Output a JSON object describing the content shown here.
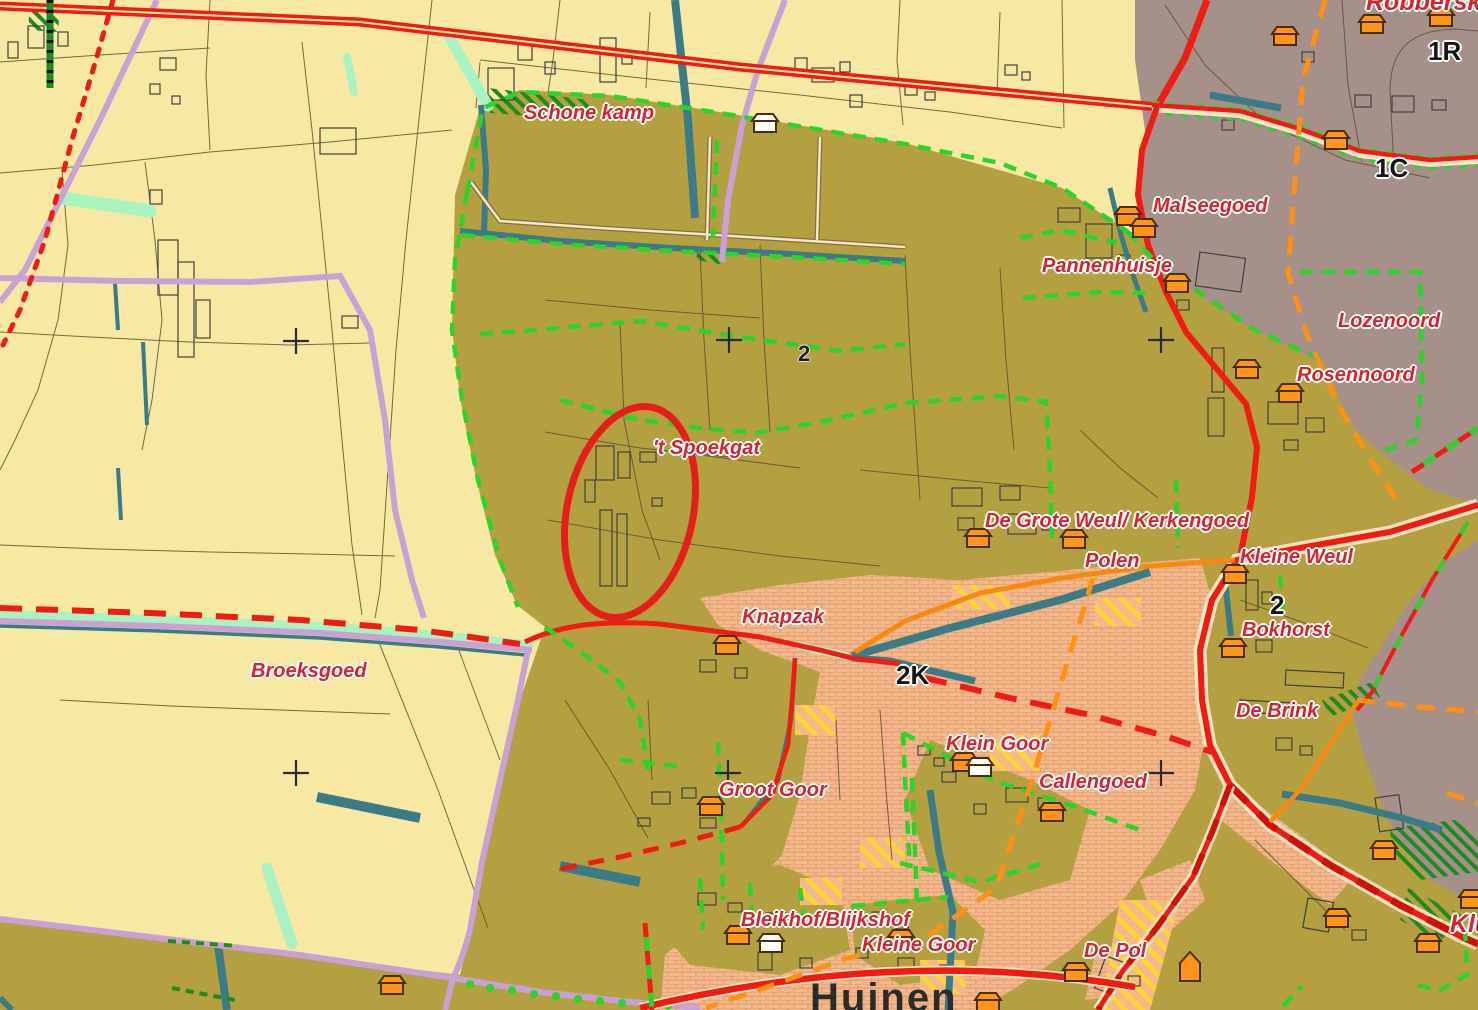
{
  "map": {
    "labels": [
      {
        "id": "schone-kamp",
        "text": "Schone kamp",
        "x": 524,
        "y": 103,
        "kind": "place"
      },
      {
        "id": "robberskamp",
        "text": "Robberskamp",
        "x": 1366,
        "y": -10,
        "kind": "place-lg"
      },
      {
        "id": "malseegoed",
        "text": "Malseegoed",
        "x": 1153,
        "y": 196,
        "kind": "place"
      },
      {
        "id": "pannenhuisje",
        "text": "Pannenhuisje",
        "x": 1042,
        "y": 256,
        "kind": "place"
      },
      {
        "id": "lozenoord",
        "text": "Lozenoord",
        "x": 1338,
        "y": 311,
        "kind": "place"
      },
      {
        "id": "rosennoord",
        "text": "Rosennoord",
        "x": 1297,
        "y": 365,
        "kind": "place"
      },
      {
        "id": "t-spoekgat",
        "text": "'t Spoekgat",
        "x": 653,
        "y": 438,
        "kind": "place"
      },
      {
        "id": "de-grote-weul-kerkengoed",
        "text": "De Grote Weul/ Kerkengoed",
        "x": 985,
        "y": 511,
        "kind": "place"
      },
      {
        "id": "polen",
        "text": "Polen",
        "x": 1085,
        "y": 551,
        "kind": "place"
      },
      {
        "id": "kleine-weul",
        "text": "Kleine Weul",
        "x": 1240,
        "y": 547,
        "kind": "place"
      },
      {
        "id": "knapzak",
        "text": "Knapzak",
        "x": 742,
        "y": 607,
        "kind": "place"
      },
      {
        "id": "bokhorst",
        "text": "Bokhorst",
        "x": 1242,
        "y": 620,
        "kind": "place"
      },
      {
        "id": "broeksgoed",
        "text": "Broeksgoed",
        "x": 251,
        "y": 661,
        "kind": "place"
      },
      {
        "id": "de-brink",
        "text": "De Brink",
        "x": 1236,
        "y": 701,
        "kind": "place"
      },
      {
        "id": "klein-goor",
        "text": "Klein Goor",
        "x": 946,
        "y": 734,
        "kind": "place"
      },
      {
        "id": "callengoed",
        "text": "Callengoed",
        "x": 1039,
        "y": 772,
        "kind": "place"
      },
      {
        "id": "groot-goor",
        "text": "Groot Goor",
        "x": 719,
        "y": 780,
        "kind": "place"
      },
      {
        "id": "bleikhof-blijkshof",
        "text": "Bleikhof/Blijkshof",
        "x": 741,
        "y": 910,
        "kind": "place"
      },
      {
        "id": "kleine-goor",
        "text": "Kleine Goor",
        "x": 862,
        "y": 935,
        "kind": "place"
      },
      {
        "id": "de-pol",
        "text": "De Pol",
        "x": 1084,
        "y": 941,
        "kind": "place"
      },
      {
        "id": "klu-clipped",
        "text": "Klu",
        "x": 1450,
        "y": 912,
        "kind": "place-lg"
      },
      {
        "id": "huinen",
        "text": "Huinen",
        "x": 810,
        "y": 978,
        "kind": "town"
      },
      {
        "id": "code-2-center",
        "text": "2",
        "x": 798,
        "y": 343,
        "kind": "code-sm"
      },
      {
        "id": "code-2k",
        "text": "2K",
        "x": 896,
        "y": 662,
        "kind": "code"
      },
      {
        "id": "code-2-right",
        "text": "2",
        "x": 1270,
        "y": 592,
        "kind": "code"
      },
      {
        "id": "code-1r",
        "text": "1R",
        "x": 1428,
        "y": 38,
        "kind": "code"
      },
      {
        "id": "code-1c",
        "text": "1C",
        "x": 1375,
        "y": 155,
        "kind": "code"
      }
    ],
    "houses": [
      {
        "x": 1285,
        "y": 38,
        "v": "o"
      },
      {
        "x": 1372,
        "y": 26,
        "v": "o"
      },
      {
        "x": 1441,
        "y": 19,
        "v": "o"
      },
      {
        "x": 1336,
        "y": 142,
        "v": "o"
      },
      {
        "x": 1128,
        "y": 218,
        "v": "o"
      },
      {
        "x": 1144,
        "y": 230,
        "v": "o"
      },
      {
        "x": 1177,
        "y": 285,
        "v": "o"
      },
      {
        "x": 765,
        "y": 125,
        "v": "w"
      },
      {
        "x": 1247,
        "y": 371,
        "v": "o"
      },
      {
        "x": 1290,
        "y": 395,
        "v": "o"
      },
      {
        "x": 978,
        "y": 540,
        "v": "o"
      },
      {
        "x": 1074,
        "y": 541,
        "v": "o"
      },
      {
        "x": 1235,
        "y": 576,
        "v": "o"
      },
      {
        "x": 1233,
        "y": 650,
        "v": "o"
      },
      {
        "x": 727,
        "y": 647,
        "v": "o"
      },
      {
        "x": 964,
        "y": 764,
        "v": "o"
      },
      {
        "x": 980,
        "y": 769,
        "v": "w"
      },
      {
        "x": 1052,
        "y": 814,
        "v": "o"
      },
      {
        "x": 711,
        "y": 808,
        "v": "o"
      },
      {
        "x": 738,
        "y": 937,
        "v": "o"
      },
      {
        "x": 771,
        "y": 945,
        "v": "w"
      },
      {
        "x": 901,
        "y": 941,
        "v": "o"
      },
      {
        "x": 1076,
        "y": 974,
        "v": "o"
      },
      {
        "x": 1190,
        "y": 969,
        "v": "t"
      },
      {
        "x": 1384,
        "y": 852,
        "v": "o"
      },
      {
        "x": 1337,
        "y": 920,
        "v": "o"
      },
      {
        "x": 1428,
        "y": 945,
        "v": "o"
      },
      {
        "x": 1472,
        "y": 901,
        "v": "o"
      },
      {
        "x": 392,
        "y": 987,
        "v": "o"
      },
      {
        "x": 988,
        "y": 1004,
        "v": "o"
      }
    ],
    "crosses": [
      {
        "x": 296,
        "y": 341
      },
      {
        "x": 729,
        "y": 340
      },
      {
        "x": 1161,
        "y": 340
      },
      {
        "x": 296,
        "y": 773
      },
      {
        "x": 728,
        "y": 773
      },
      {
        "x": 1161,
        "y": 773
      }
    ],
    "annotation": {
      "shape": "ellipse",
      "cx": 630,
      "cy": 512,
      "rx": 63,
      "ry": 107,
      "rotate": 12,
      "color": "#e41f1b"
    },
    "colors": {
      "field_yellow": "#f7e9a4",
      "farmland_olive": "#b4a041",
      "builtup_mauve": "#a5918a",
      "village_salmon": "#f3b88c",
      "water_teal": "#3a7b85",
      "water_mint": "#a9f2c1",
      "road_red": "#ee1c12",
      "road_lilac": "#c9a1d4",
      "road_orange": "#f58a10",
      "boundary_green": "#2bd32b",
      "boundary_orange_dash": "#ff9015",
      "forest_green": "#1f8a1f",
      "house_orange": "#ff9617",
      "label_red": "#d12530",
      "label_black": "#151515"
    }
  }
}
